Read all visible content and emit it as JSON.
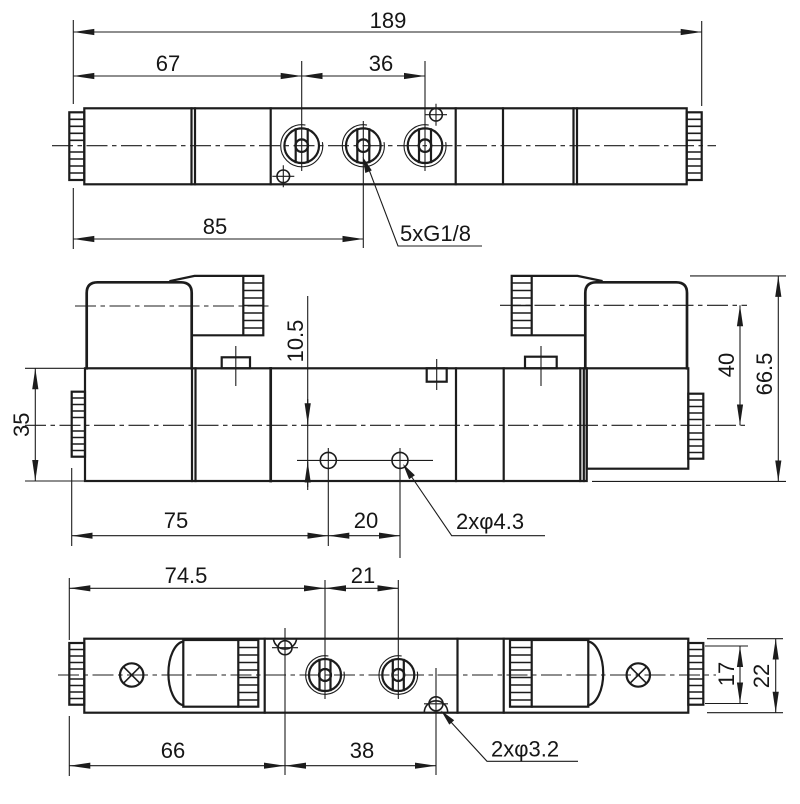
{
  "drawing": {
    "background_color": "#ffffff",
    "line_color": "#1c1c1c",
    "views": {
      "top": {
        "dims": {
          "overall_length": "189",
          "left_to_port1": "67",
          "port1_to_port3": "36",
          "left_to_port2": "85"
        },
        "ports_label": "5xG1/8"
      },
      "front": {
        "dims": {
          "pilot_height": "35",
          "hole_offset": "10.5",
          "coil_axis_height": "40",
          "overall_height": "66.5",
          "left_to_hole1": "75",
          "hole_spacing": "20"
        },
        "holes_label": "2xφ4.3"
      },
      "bottom": {
        "dims": {
          "left_to_port1": "74.5",
          "port_spacing": "21",
          "left_to_hole1": "66",
          "hole1_to_hole2": "38",
          "cap_height": "17",
          "body_height": "22"
        },
        "holes_label": "2xφ3.2"
      }
    }
  }
}
